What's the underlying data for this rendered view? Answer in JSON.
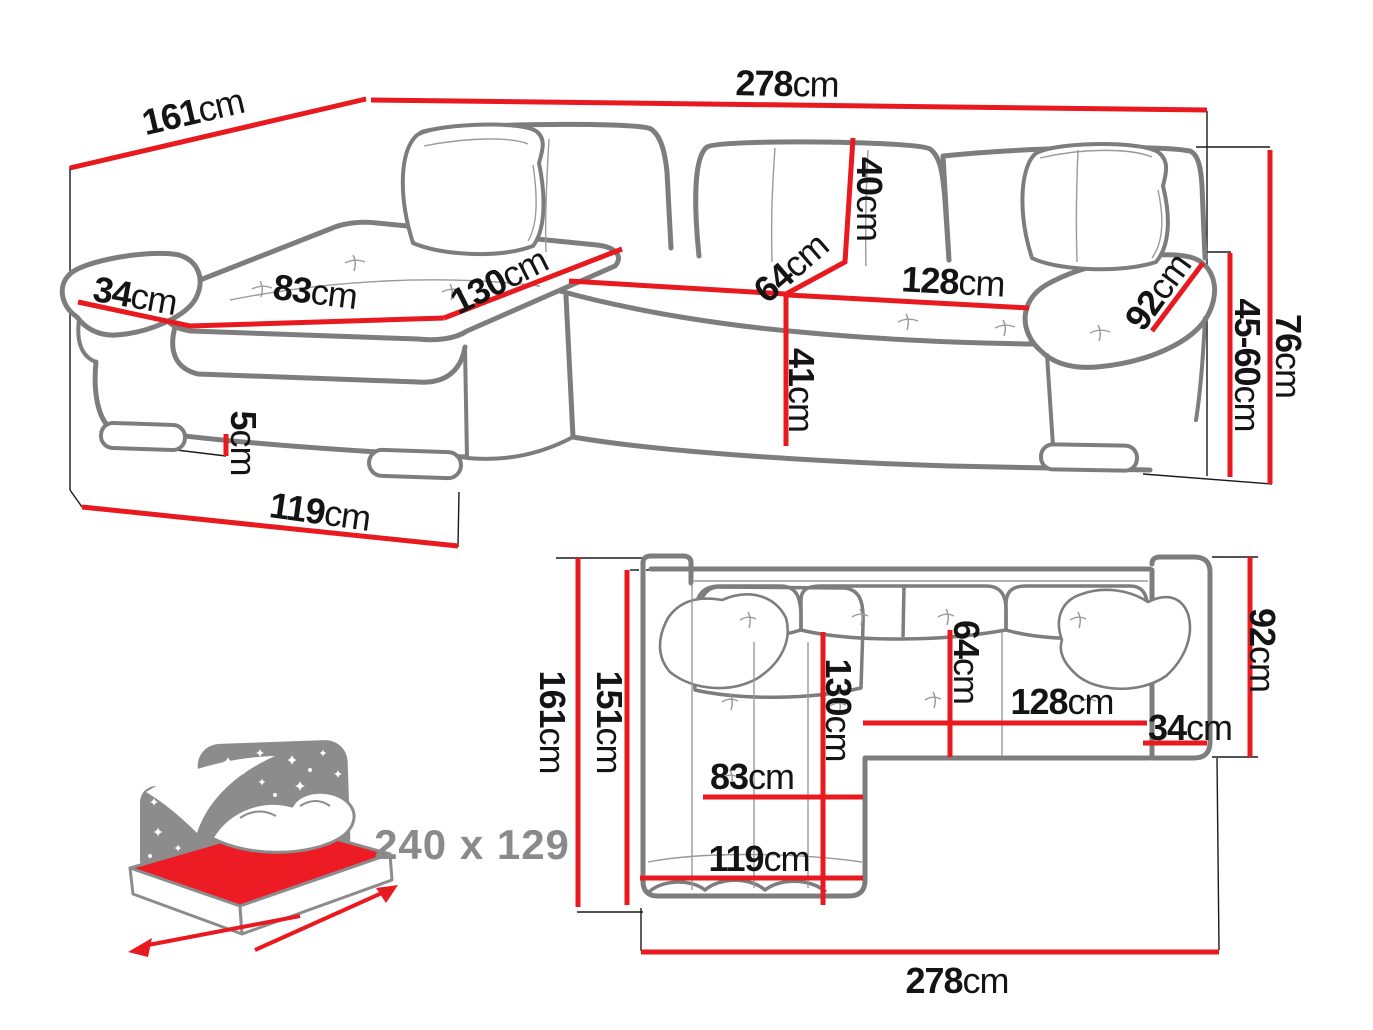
{
  "colors": {
    "dimension_red": "#e8191f",
    "sofa_outline_gray": "#7d7d7d",
    "detail_gray": "#9a9a9a",
    "label_black": "#141414",
    "icon_gray": "#8c8c8c",
    "mattress_red": "#ed1c24"
  },
  "perspective_view": {
    "description": "corner sofa perspective view with dimensions",
    "measurements": {
      "total_depth": {
        "value": "161",
        "unit": "cm"
      },
      "total_width": {
        "value": "278",
        "unit": "cm"
      },
      "armrest_width": {
        "value": "34",
        "unit": "cm"
      },
      "chaise_seat_width": {
        "value": "83",
        "unit": "cm"
      },
      "chaise_length": {
        "value": "130",
        "unit": "cm"
      },
      "backrest_height": {
        "value": "40",
        "unit": "cm"
      },
      "seat_depth": {
        "value": "64",
        "unit": "cm"
      },
      "seat_width": {
        "value": "128",
        "unit": "cm"
      },
      "armrest_length": {
        "value": "92",
        "unit": "cm"
      },
      "seat_height": {
        "value": "41",
        "unit": "cm"
      },
      "armrest_height": {
        "value": "45-60",
        "unit": "cm"
      },
      "total_height": {
        "value": "76",
        "unit": "cm"
      },
      "leg_height": {
        "value": "5",
        "unit": "cm"
      },
      "chaise_depth": {
        "value": "119",
        "unit": "cm"
      }
    }
  },
  "top_view": {
    "description": "corner sofa top view with dimensions",
    "measurements": {
      "total_depth": {
        "value": "161",
        "unit": "cm"
      },
      "inner_depth": {
        "value": "151",
        "unit": "cm"
      },
      "chaise_length": {
        "value": "130",
        "unit": "cm"
      },
      "seat_depth": {
        "value": "64",
        "unit": "cm"
      },
      "chaise_seat_width": {
        "value": "83",
        "unit": "cm"
      },
      "chaise_width": {
        "value": "119",
        "unit": "cm"
      },
      "seat_width": {
        "value": "128",
        "unit": "cm"
      },
      "armrest_width": {
        "value": "34",
        "unit": "cm"
      },
      "armrest_length": {
        "value": "92",
        "unit": "cm"
      },
      "total_width": {
        "value": "278",
        "unit": "cm"
      }
    }
  },
  "sleeping_area": {
    "icon": "bed-with-starry-headboard-icon",
    "dimensions_label": "240 x 129"
  }
}
